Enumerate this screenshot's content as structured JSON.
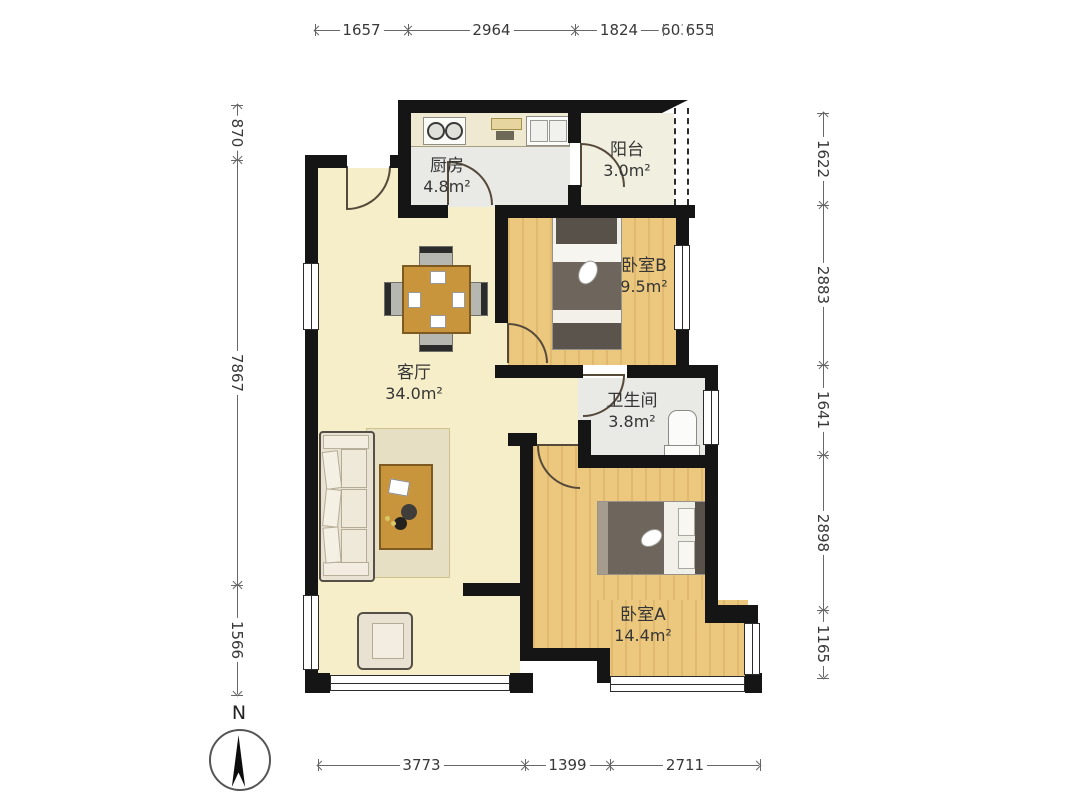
{
  "compass": {
    "label": "N"
  },
  "rooms": {
    "kitchen": {
      "name": "厨房",
      "area": "4.8m²"
    },
    "balcony": {
      "name": "阳台",
      "area": "3.0m²"
    },
    "bedroom_b": {
      "name": "卧室B",
      "area": "9.5m²"
    },
    "living": {
      "name": "客厅",
      "area": "34.0m²"
    },
    "bathroom": {
      "name": "卫生间",
      "area": "3.8m²"
    },
    "bedroom_a": {
      "name": "卧室A",
      "area": "14.4m²"
    }
  },
  "dims": {
    "top": [
      "1657",
      "2964",
      "1824",
      "603",
      "655"
    ],
    "bottom": [
      "3773",
      "1399",
      "2711"
    ],
    "left": [
      "870",
      "7867",
      "1566"
    ],
    "right": [
      "1622",
      "2883",
      "1641",
      "2898",
      "1165"
    ]
  },
  "colors": {
    "wall": "#151515",
    "wood_floor": "#ecc87f",
    "cream_floor": "#f6eec9",
    "tile_floor": "#e9e9e6",
    "dim_line": "#676767"
  }
}
